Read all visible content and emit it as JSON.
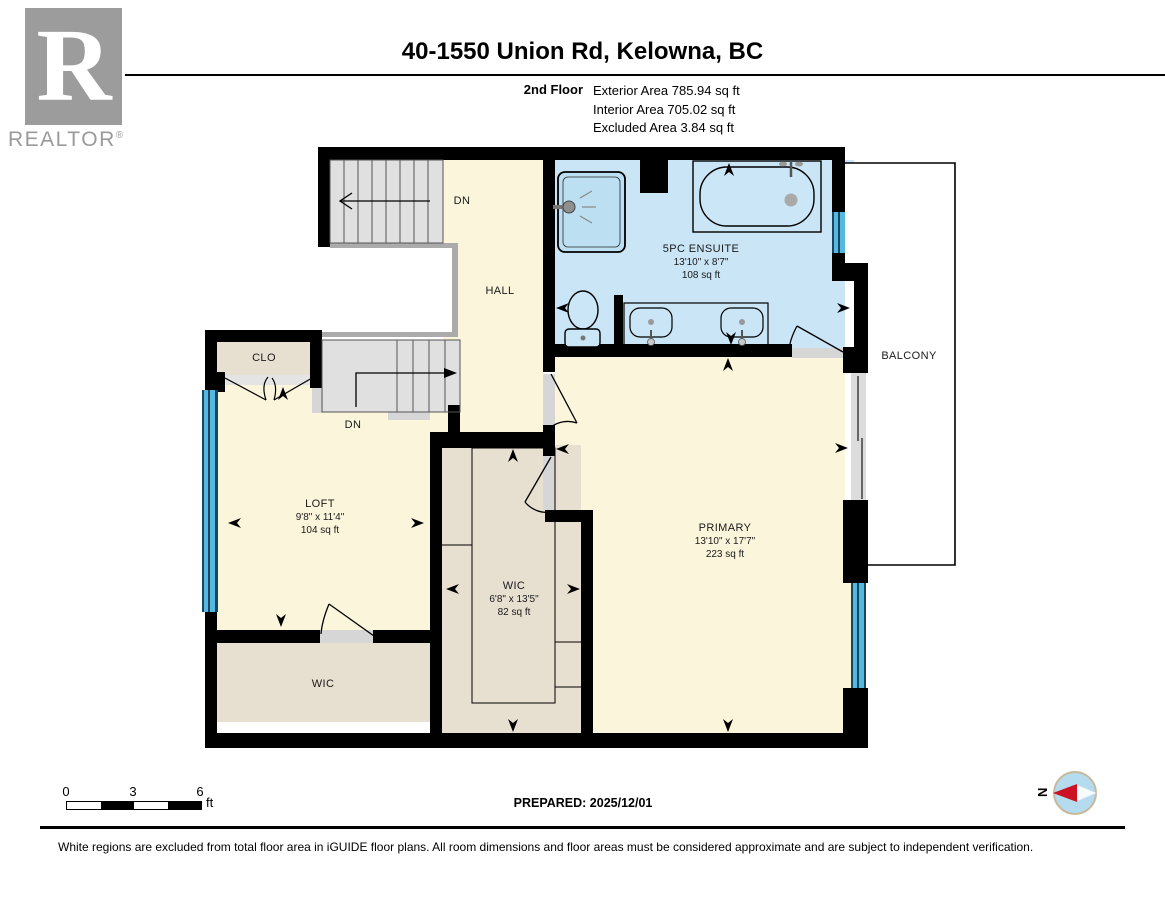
{
  "header": {
    "logo_text": "REALTOR",
    "logo_reg": "®",
    "title": "40-1550 Union Rd, Kelowna, BC",
    "floor_label": "2nd Floor",
    "stats": {
      "exterior": "Exterior Area 785.94 sq ft",
      "interior": "Interior Area 705.02 sq ft",
      "excluded": "Excluded Area 3.84 sq ft"
    }
  },
  "rooms": {
    "hall": {
      "name": "HALL"
    },
    "clo": {
      "name": "CLO"
    },
    "stairs_upper": {
      "label": "DN"
    },
    "stairs_lower": {
      "label": "DN"
    },
    "loft": {
      "name": "LOFT",
      "dims": "9'8\" x 11'4\"",
      "area": "104 sq ft"
    },
    "wic": {
      "name": "WIC",
      "dims": "6'8\" x 13'5\"",
      "area": "82 sq ft"
    },
    "wic2": {
      "name": "WIC"
    },
    "primary": {
      "name": "PRIMARY",
      "dims": "13'10\" x 17'7\"",
      "area": "223 sq ft"
    },
    "ensuite": {
      "name": "5PC ENSUITE",
      "dims": "13'10\" x 8'7\"",
      "area": "108 sq ft"
    },
    "balcony": {
      "name": "BALCONY"
    }
  },
  "footer": {
    "scale": {
      "tick0": "0",
      "tick3": "3",
      "tick6": "6",
      "unit": "ft"
    },
    "prepared": "PREPARED: 2025/12/01",
    "compass_n": "N",
    "disclaimer": "White regions are excluded from total floor area in iGUIDE floor plans. All room dimensions and floor areas must be considered approximate and are subject to independent verification."
  },
  "colors": {
    "wall": "#000000",
    "room_cream": "#FBF5DB",
    "room_tan": "#E7DFD0",
    "ensuite_blue": "#C9E5F6",
    "window_cyan": "#56B8E0",
    "stairs_gray": "#E0E0E0",
    "door_gray": "#D6D6D6",
    "compass_red": "#CC1122",
    "logo_gray": "#9C9C9C"
  }
}
